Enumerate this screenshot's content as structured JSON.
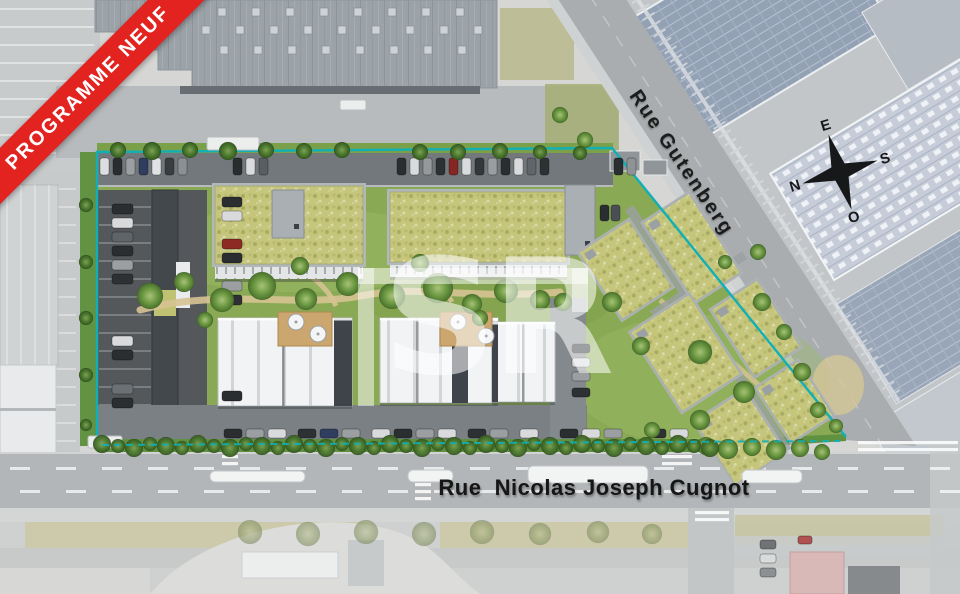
{
  "banner": {
    "label": "PROGRAMME NEUF",
    "bg": "#e2231f",
    "fg": "#ffffff"
  },
  "labels": {
    "street_diagonal": "Rue Gutenberg",
    "street_bottom": "Rue  Nicolas Joseph Cugnot"
  },
  "compass": {
    "north": "N",
    "east": "E",
    "south": "S",
    "west": "O"
  },
  "watermark": {
    "text": "SR"
  },
  "colors": {
    "boundary": "#10b0b6",
    "banner_bg": "#e2231f",
    "lawn": "#8aa955",
    "sedum_roof": "#c5c67c",
    "asphalt": "#54585b",
    "internal_street": "#73787c",
    "gutenberg_road": "#a9adaf",
    "cugnot_road": "#b2b6b8",
    "warehouse_roof": "#9ba3a9",
    "solar_roof": "#93a1b5",
    "hedge": "#5f9140",
    "tree": "#4c7a30",
    "faded_surround": "#d6d7d5",
    "deck": "#cba76f",
    "white_roof": "#f2f3f5"
  },
  "scene": {
    "skylights": {
      "rows": [
        8,
        26,
        46
      ],
      "x0": [
        218,
        202,
        220
      ],
      "count": [
        8,
        9,
        8
      ],
      "step": 34,
      "size": 8
    },
    "green_roof_buildings": [
      {
        "x": 215,
        "y": 186,
        "w": 148,
        "h": 78,
        "core": [
          272,
          190,
          32,
          48
        ],
        "facade_h": 12
      },
      {
        "x": 390,
        "y": 192,
        "w": 177,
        "h": 70,
        "core": [
          565,
          185,
          30,
          70
        ],
        "facade_h": 12
      }
    ],
    "white_groups": [
      {
        "x": 218,
        "y": 318,
        "w": 134,
        "h": 88,
        "dark": [
          [
            116,
            0,
            18,
            88
          ]
        ],
        "seams": [
          64
        ]
      },
      {
        "x": 380,
        "y": 318,
        "w": 118,
        "h": 85,
        "dark": [
          [
            72,
            0,
            16,
            85
          ]
        ],
        "seams": [
          36
        ]
      },
      {
        "x": 492,
        "y": 322,
        "w": 63,
        "h": 80,
        "dark": [
          [
            0,
            0,
            6,
            80
          ]
        ],
        "seams": [
          30
        ]
      }
    ],
    "terraces": [
      {
        "x": 278,
        "y": 312,
        "w": 54,
        "h": 34,
        "umbrellas": [
          [
            296,
            322
          ],
          [
            318,
            334
          ]
        ]
      },
      {
        "x": 440,
        "y": 312,
        "w": 52,
        "h": 34,
        "umbrellas": [
          [
            458,
            322
          ],
          [
            486,
            336
          ]
        ]
      }
    ],
    "cluster": {
      "cx": 715,
      "cy": 325,
      "angle": -33,
      "blocks": [
        [
          640,
          190,
          60,
          80
        ],
        [
          710,
          200,
          55,
          95
        ],
        [
          640,
          285,
          70,
          95
        ],
        [
          720,
          310,
          55,
          80
        ],
        [
          645,
          395,
          60,
          75
        ],
        [
          715,
          400,
          50,
          65
        ]
      ],
      "connectors": [
        [
          668,
          278,
          110,
          9
        ],
        [
          702,
          180,
          10,
          290
        ]
      ]
    },
    "cars": {
      "top_row": {
        "y": 158,
        "w": 9,
        "h": 17,
        "items": [
          [
            100,
            "#dcdedf"
          ],
          [
            113,
            "#2a2d2f"
          ],
          [
            126,
            "#9b9fa2"
          ],
          [
            139,
            "#2f3e5e"
          ],
          [
            152,
            "#e0e2e3"
          ],
          [
            165,
            "#3a3d40"
          ],
          [
            178,
            "#8c9093"
          ],
          [
            233,
            "#2a2d2f"
          ],
          [
            246,
            "#d9dbdc"
          ],
          [
            259,
            "#5a5e61"
          ],
          [
            397,
            "#2b2e30"
          ],
          [
            410,
            "#d8dadb"
          ],
          [
            423,
            "#95999c"
          ],
          [
            436,
            "#2e3133"
          ],
          [
            449,
            "#842722"
          ],
          [
            462,
            "#d8dadb"
          ],
          [
            475,
            "#34383a"
          ],
          [
            488,
            "#9a9ea1"
          ],
          [
            501,
            "#2b2e30"
          ],
          [
            514,
            "#d8dadb"
          ],
          [
            527,
            "#60656a"
          ],
          [
            540,
            "#2e3133"
          ],
          [
            614,
            "#2b2e30"
          ],
          [
            627,
            "#8f9396"
          ]
        ]
      },
      "left_col": {
        "x": 112,
        "w": 21,
        "h": 10,
        "items": [
          [
            204,
            "#2b2e30"
          ],
          [
            218,
            "#d8dadb"
          ],
          [
            232,
            "#5f6468"
          ],
          [
            246,
            "#2b2e30"
          ],
          [
            260,
            "#9b9fa2"
          ],
          [
            274,
            "#2e3133"
          ],
          [
            336,
            "#d8dadb"
          ],
          [
            350,
            "#2b2e30"
          ],
          [
            384,
            "#6b7074"
          ],
          [
            398,
            "#2b2e30"
          ]
        ]
      },
      "mid_col": {
        "x": 222,
        "w": 20,
        "h": 10,
        "items": [
          [
            197,
            "#2b2e30"
          ],
          [
            211,
            "#d8dadb"
          ],
          [
            239,
            "#8e2a24"
          ],
          [
            253,
            "#2b2e30"
          ],
          [
            281,
            "#9b9fa2"
          ],
          [
            295,
            "#2e3133"
          ],
          [
            391,
            "#2b2e30"
          ]
        ]
      },
      "bottom_row": {
        "y": 429,
        "w": 18,
        "h": 9,
        "items": [
          [
            224,
            "#2b2e30"
          ],
          [
            246,
            "#9b9fa2"
          ],
          [
            268,
            "#d8dadb"
          ],
          [
            298,
            "#2e3133"
          ],
          [
            320,
            "#2f3e5e"
          ],
          [
            342,
            "#9b9fa2"
          ],
          [
            372,
            "#d8dadb"
          ],
          [
            394,
            "#2b2e30"
          ],
          [
            416,
            "#9b9fa2"
          ],
          [
            438,
            "#d8dadb"
          ],
          [
            468,
            "#2e3133"
          ],
          [
            490,
            "#9b9fa2"
          ],
          [
            520,
            "#d8dadb"
          ],
          [
            560,
            "#2b2e30"
          ],
          [
            582,
            "#d8dadb"
          ],
          [
            604,
            "#9b9fa2"
          ],
          [
            648,
            "#2e3133"
          ],
          [
            670,
            "#d8dadb"
          ]
        ]
      },
      "right_col": {
        "x": 572,
        "w": 18,
        "h": 9,
        "items": [
          [
            344,
            "#2b2e30"
          ],
          [
            358,
            "#d8dadb"
          ],
          [
            372,
            "#9b9fa2"
          ],
          [
            388,
            "#2e3133"
          ]
        ]
      },
      "street_pair": {
        "y": 205,
        "w": 9,
        "h": 16,
        "items": [
          [
            600,
            "#2b2e30"
          ],
          [
            611,
            "#4a4f53"
          ]
        ]
      },
      "faded_col": {
        "x": 760,
        "w": 16,
        "h": 9,
        "items": [
          [
            540,
            "#6f7376"
          ],
          [
            554,
            "#d8dadb"
          ],
          [
            568,
            "#8c9093"
          ]
        ]
      },
      "extra": [
        [
          798,
          536,
          14,
          8,
          "#b05252"
        ]
      ]
    },
    "buses": [
      [
        210,
        471,
        95,
        11
      ],
      [
        408,
        470,
        45,
        12
      ],
      [
        528,
        466,
        120,
        17
      ],
      [
        742,
        470,
        60,
        13
      ]
    ],
    "trucks": [
      [
        207,
        137,
        52,
        13
      ],
      [
        340,
        100,
        26,
        10
      ],
      [
        88,
        436,
        34,
        12
      ]
    ],
    "trees": {
      "site": [
        [
          150,
          296,
          13
        ],
        [
          184,
          282,
          10
        ],
        [
          222,
          300,
          12
        ],
        [
          262,
          286,
          14
        ],
        [
          306,
          299,
          11
        ],
        [
          348,
          284,
          12
        ],
        [
          392,
          296,
          13
        ],
        [
          438,
          288,
          15
        ],
        [
          472,
          304,
          10
        ],
        [
          506,
          291,
          12
        ],
        [
          540,
          300,
          10
        ],
        [
          300,
          266,
          9
        ],
        [
          420,
          263,
          9
        ],
        [
          205,
          320,
          8
        ],
        [
          480,
          318,
          8
        ],
        [
          563,
          302,
          9
        ],
        [
          612,
          302,
          10
        ],
        [
          641,
          346,
          9
        ],
        [
          700,
          352,
          12
        ],
        [
          744,
          392,
          11
        ],
        [
          762,
          302,
          9
        ],
        [
          784,
          332,
          8
        ],
        [
          802,
          372,
          9
        ],
        [
          818,
          410,
          8
        ],
        [
          700,
          420,
          10
        ],
        [
          652,
          430,
          8
        ],
        [
          836,
          426,
          7
        ],
        [
          758,
          252,
          8
        ],
        [
          725,
          262,
          7
        ],
        [
          560,
          115,
          8
        ],
        [
          585,
          140,
          8
        ]
      ],
      "top_row": [
        [
          118,
          150,
          8
        ],
        [
          152,
          151,
          9
        ],
        [
          190,
          150,
          8
        ],
        [
          228,
          151,
          9
        ],
        [
          266,
          150,
          8
        ],
        [
          304,
          151,
          8
        ],
        [
          342,
          150,
          8
        ],
        [
          420,
          152,
          8
        ],
        [
          458,
          152,
          8
        ],
        [
          500,
          151,
          8
        ],
        [
          540,
          152,
          7
        ],
        [
          580,
          153,
          7
        ]
      ],
      "left_col": [
        [
          86,
          205,
          7
        ],
        [
          86,
          262,
          7
        ],
        [
          86,
          318,
          7
        ],
        [
          86,
          375,
          7
        ],
        [
          86,
          425,
          6
        ]
      ],
      "hedge_row": {
        "from": 102,
        "to": 718,
        "step": 16,
        "y": 446,
        "r": 9
      },
      "road_right": [
        [
          706,
          446,
          9
        ],
        [
          728,
          449,
          10
        ],
        [
          752,
          447,
          9
        ],
        [
          776,
          450,
          10
        ],
        [
          800,
          448,
          9
        ],
        [
          822,
          452,
          8
        ]
      ],
      "faded": [
        [
          250,
          532,
          12
        ],
        [
          308,
          534,
          12
        ],
        [
          366,
          532,
          12
        ],
        [
          424,
          534,
          12
        ],
        [
          482,
          532,
          12
        ],
        [
          540,
          534,
          11
        ],
        [
          598,
          532,
          11
        ],
        [
          652,
          534,
          10
        ]
      ]
    },
    "road_dashes": [
      {
        "y": 467,
        "from": 10,
        "to": 950,
        "step": 46,
        "w": 20,
        "h": 3
      },
      {
        "y": 490,
        "from": 20,
        "to": 950,
        "step": 46,
        "w": 20,
        "h": 3
      }
    ],
    "crosswalks": [
      [
        415,
        478,
        16,
        26
      ],
      [
        662,
        452,
        30,
        16
      ],
      [
        695,
        510,
        34,
        12
      ],
      [
        222,
        455,
        16,
        14
      ],
      [
        858,
        438,
        100,
        15
      ]
    ]
  }
}
